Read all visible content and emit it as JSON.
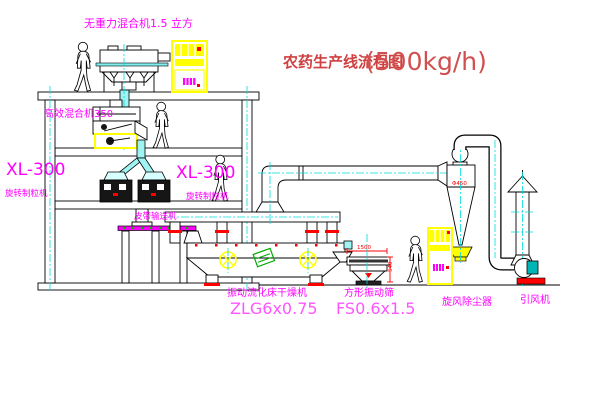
{
  "title": {
    "cn": "农药生产线流程图",
    "capacity": "(500kg/h)"
  },
  "labels": {
    "top_mixer": "无重力混合机1.5 立方",
    "mixer2": "高效混合机350",
    "xl_left": "XL-300",
    "xl_left_sub": "旋转制粒机",
    "xl_right": "XL-300",
    "xl_right_sub": "旋转制粒机",
    "belt_conveyor": "皮带输送机",
    "dryer_name": "振动流化床干燥机",
    "dryer_model": "ZLG6x0.75",
    "screen_name": "方形振动筛",
    "screen_model": "FS0.6x1.5",
    "cyclone": "旋风除尘器",
    "fan": "引风机"
  },
  "dimensions": {
    "screen_width": "1500",
    "screen_height": "540",
    "cyclone_dia": "Φ450"
  },
  "colors": {
    "label_magenta": "#ff00ff",
    "title_red": "#d04040",
    "dimension_red": "#ff0000",
    "equipment_yellow": "#ffff00",
    "centerline_cyan": "#00dddd",
    "conveyor_green": "#00bb00",
    "line_black": "#000000"
  }
}
